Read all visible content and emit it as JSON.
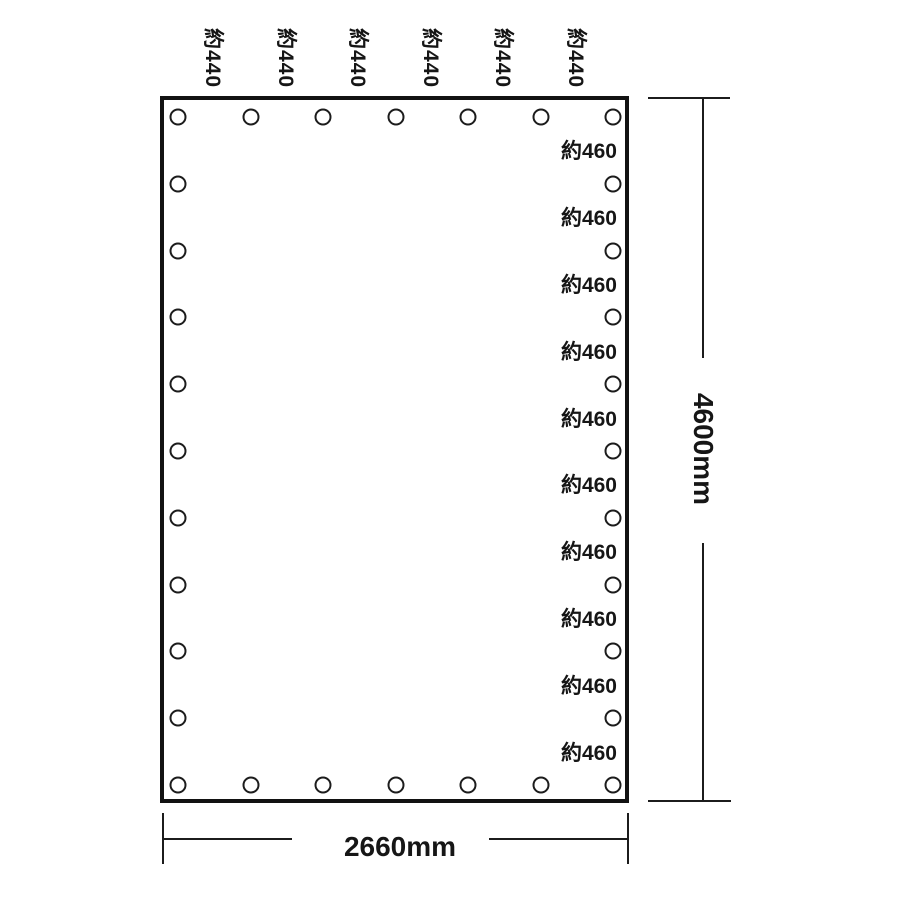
{
  "diagram": {
    "background_color": "#ffffff",
    "line_color": "#1c1c1c",
    "sheet": {
      "width_label": "2660mm",
      "height_label": "4600mm"
    },
    "top_spacing_labels": [
      "約440",
      "約440",
      "約440",
      "約440",
      "約440",
      "約440"
    ],
    "right_spacing_labels": [
      "約460",
      "約460",
      "約460",
      "約460",
      "約460",
      "約460",
      "約460",
      "約460",
      "約460",
      "約460"
    ],
    "grommets": {
      "shape": "circle",
      "top_count": 7,
      "bottom_count": 7,
      "left_count": 11,
      "right_count": 11
    }
  }
}
